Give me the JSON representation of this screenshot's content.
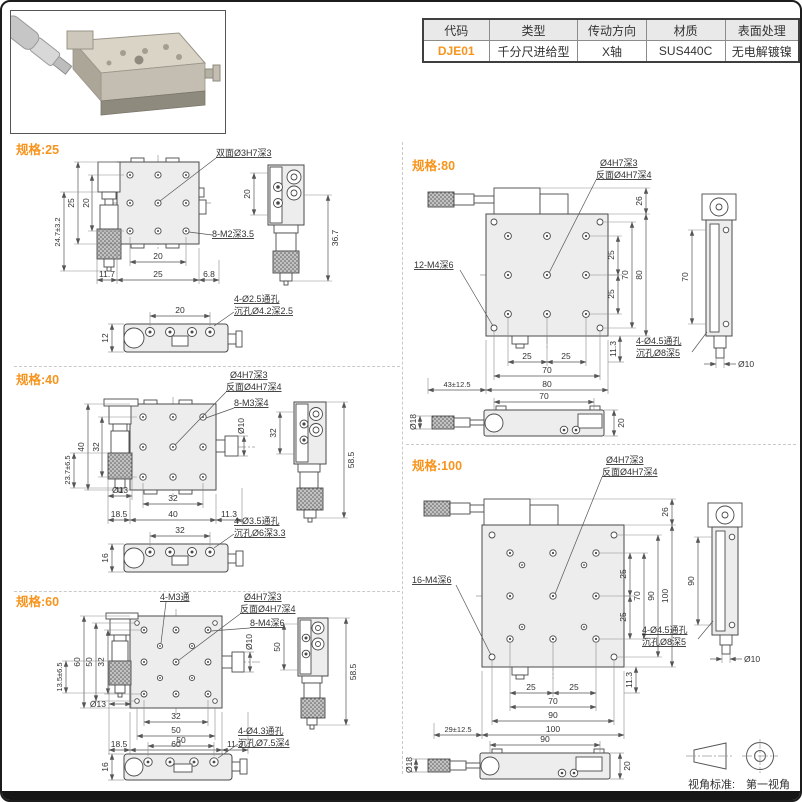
{
  "page": {
    "footer_label": "视角标准:",
    "footer_value": "第一视角"
  },
  "product_table": {
    "headers": [
      "代码",
      "类型",
      "传动方向",
      "材质",
      "表面处理"
    ],
    "values": [
      "DJE01",
      "千分尺进给型",
      "X轴",
      "SUS440C",
      "无电解镀镍"
    ]
  },
  "colors": {
    "accent": "#F7941D",
    "line": "#4a4a4a",
    "plate_fill": "#ededed"
  },
  "sections": {
    "s25": {
      "title": "规格:25",
      "callouts": {
        "center": "双面Ø3H7深3",
        "corner": "8-M2深3.5",
        "hole1": "4-Ø2.5通孔",
        "hole2": "沉孔Ø4.2深2.5"
      },
      "dims": {
        "h_outer": "25",
        "h_holes": "20",
        "mic": "24.7±3.2",
        "w_mic": "11.7",
        "w_outer": "25",
        "w_holes": "20",
        "w_right": "6.8",
        "side_holes": "20",
        "side_total": "36.7",
        "base_w": "20",
        "base_h": "12"
      }
    },
    "s40": {
      "title": "规格:40",
      "callouts": {
        "center1": "Ø4H7深3",
        "center2": "反面Ø4H7深4",
        "grid": "8-M3深4",
        "knob": "Ø10",
        "mic_d": "Ø13",
        "hole1": "4-Ø3.5通孔",
        "hole2": "沉孔Ø6深3.3"
      },
      "dims": {
        "h_outer": "40",
        "h_holes": "32",
        "mic": "23.7±6.5",
        "w_mic": "18.5",
        "w_holes": "32",
        "w_outer": "40",
        "w_right": "11.3",
        "side_holes": "32",
        "side_total": "58.5",
        "base_w": "32",
        "base_h": "16"
      }
    },
    "s60": {
      "title": "规格:60",
      "callouts": {
        "through": "4-M3通",
        "center1": "Ø4H7深3",
        "center2": "反面Ø4H7深4",
        "grid": "8-M4深6",
        "knob": "Ø10",
        "mic_d": "Ø13",
        "hole1": "4-Ø4.3通孔",
        "hole2": "沉孔Ø7.5深4"
      },
      "dims": {
        "h_outer": "60",
        "h_mid": "50",
        "h_holes": "32",
        "mic": "13.5±6.5",
        "w_mic": "18.5",
        "w_holes": "32",
        "w_mid": "50",
        "w_outer": "60",
        "w_right": "11.3",
        "side_holes": "50",
        "side_total": "58.5",
        "base_w": "50",
        "base_h": "16"
      }
    },
    "s80": {
      "title": "规格:80",
      "callouts": {
        "center1": "Ø4H7深3",
        "center2": "反面Ø4H7深4",
        "grid": "12-M4深6",
        "hole1": "4-Ø4.5通孔",
        "hole2": "沉孔Ø8深5",
        "side_d": "Ø10"
      },
      "dims": {
        "top": "26",
        "pitch1": "25",
        "pitch2": "25",
        "h_holes": "70",
        "h_outer": "80",
        "b1": "25",
        "b2": "25",
        "w_holes": "70",
        "w_outer": "80",
        "mic": "43±12.5",
        "drop": "11.3",
        "side_holes": "70",
        "base_w": "70",
        "base_d": "Ø18",
        "base_h": "20"
      }
    },
    "s100": {
      "title": "规格:100",
      "callouts": {
        "center1": "Ø4H7深3",
        "center2": "反面Ø4H7深4",
        "grid": "16-M4深6",
        "hole1": "4-Ø4.5通孔",
        "hole2": "沉孔Ø8深5",
        "side_d": "Ø10"
      },
      "dims": {
        "top": "26",
        "pitch1": "25",
        "pitch2": "25",
        "h_holes": "70",
        "h_mid": "90",
        "h_outer": "100",
        "b1": "25",
        "b2": "25",
        "w_holes": "70",
        "w_mid": "90",
        "w_outer": "100",
        "mic": "29±12.5",
        "drop": "11.3",
        "side_holes": "90",
        "base_w": "90",
        "base_d": "Ø18",
        "base_h": "20"
      }
    }
  }
}
